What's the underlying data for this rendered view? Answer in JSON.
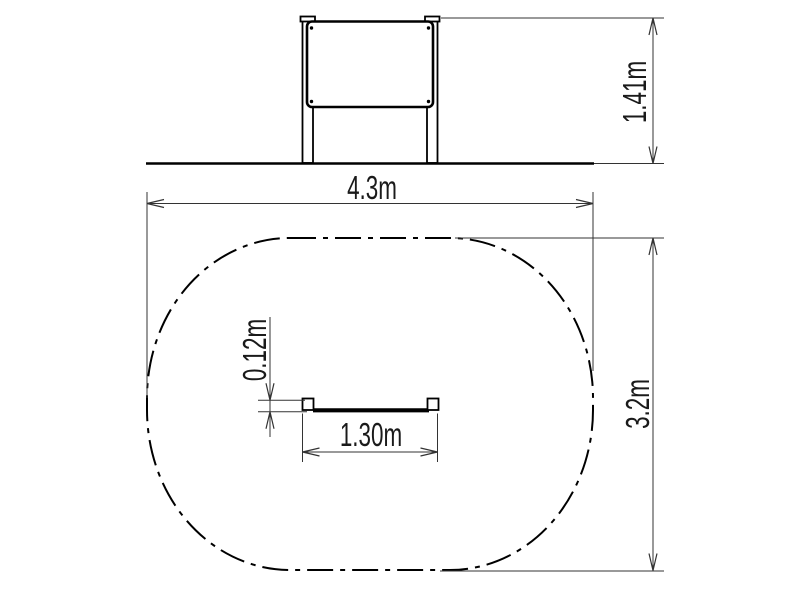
{
  "drawing": {
    "elevation": {
      "height_label": "1.41m"
    },
    "plan": {
      "zone_width_label": "4.3m",
      "zone_depth_label": "3.2m",
      "panel_width_label": "1.30m",
      "panel_depth_label": "0.12m"
    },
    "colors": {
      "object_line": "#000000",
      "dimension_line": "#333333",
      "text": "#1a1a1a",
      "background": "#ffffff"
    }
  }
}
